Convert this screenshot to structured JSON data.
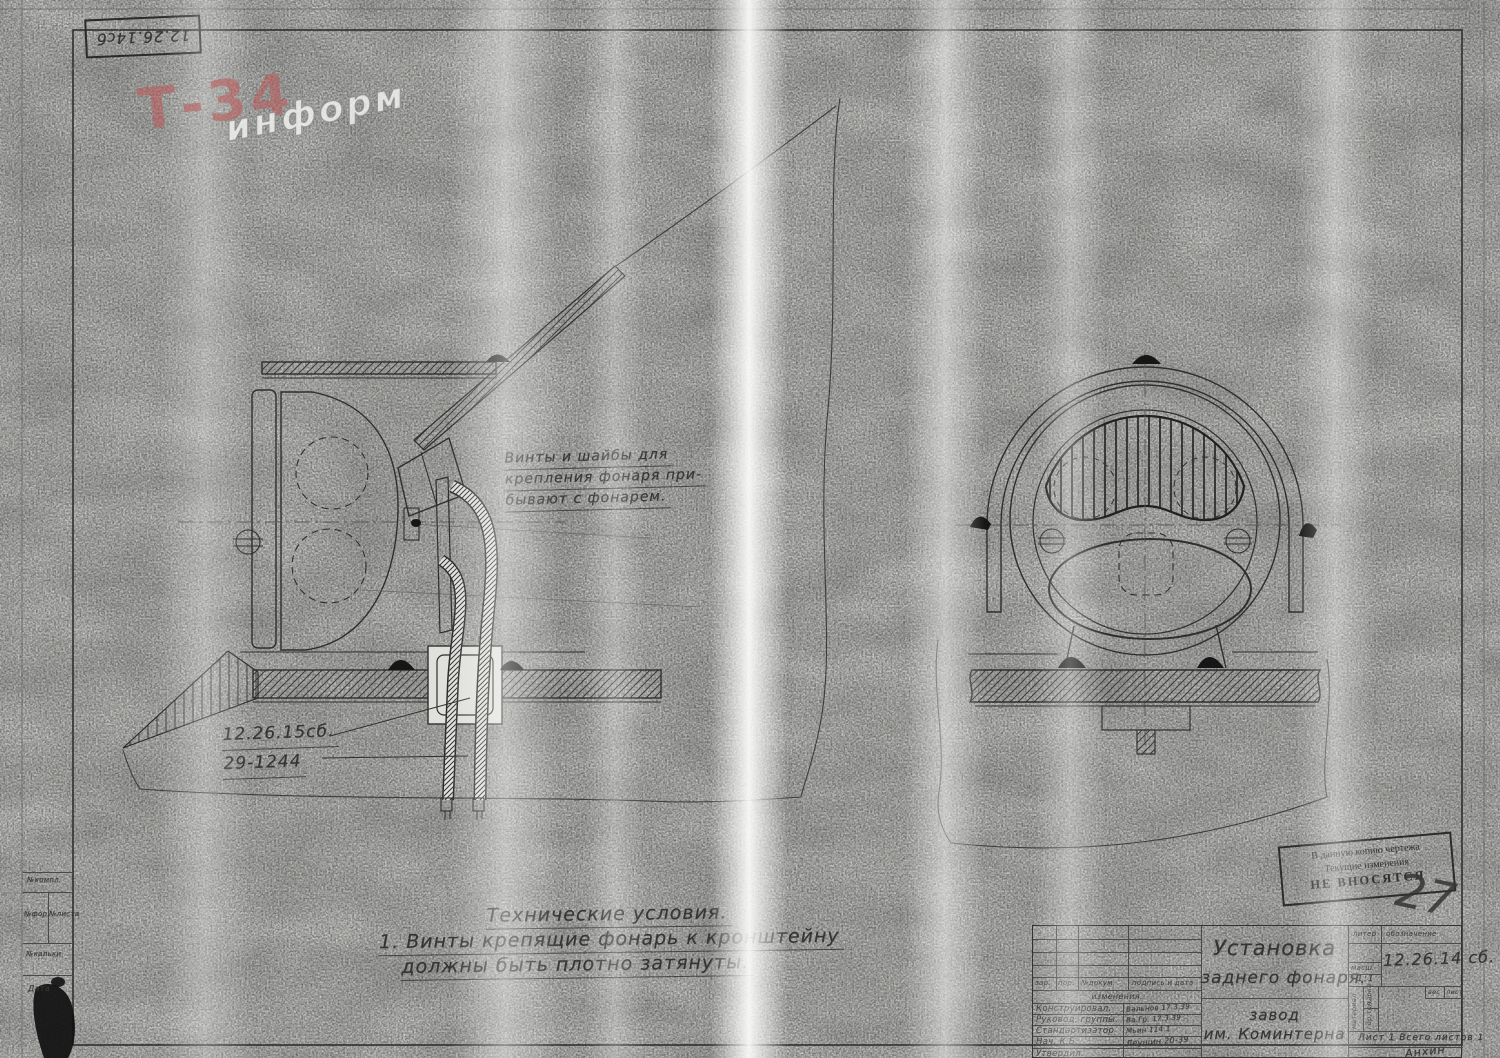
{
  "colors": {
    "paper": "#d8d8d5",
    "ink": "#2e2e2e",
    "watermark_red": "#bc5858"
  },
  "sheet": {
    "corner_code": "12.26.14сб"
  },
  "watermark": {
    "main": "Т-34",
    "sub": "информ"
  },
  "annotations": {
    "note": [
      "Винты и шайбы для",
      "крепления фонаря при-",
      "бывают с фонарем."
    ],
    "part_label_1": "12.26.15сб.",
    "part_label_2": "29-1244",
    "tech_title": "Технические условия.",
    "tech_line_1": "1. Винты крепящие фонарь к кронштейну",
    "tech_line_2": "должны быть плотно затянуты."
  },
  "stamp": {
    "line1": "В данную копию чертежа",
    "line2": "Текущие изменения",
    "line3": "НЕ ВНОСЯТСЯ",
    "mark": "27"
  },
  "margin_table": {
    "row1": "№компл.",
    "row2a": "№фор.",
    "row2b": "№листа",
    "row3": "№кальки",
    "row4": "Дата"
  },
  "title_block": {
    "rev_cols": [
      "зар.",
      "пор.",
      "№докум.",
      "подпись и дата"
    ],
    "rev_caption": "изменения.",
    "roles": [
      {
        "label": "Конструировал.",
        "sign": "Вальнов 17.3.39"
      },
      {
        "label": "Руковод. группы.",
        "sign": "Ва.Гр. 17.3.39"
      },
      {
        "label": "Стандартизатор",
        "sign": "Мьин 114.1"
      },
      {
        "label": "Нач. К.Б.",
        "sign": "Леушин 20-39"
      },
      {
        "label": "Утвердил.",
        "sign": ""
      }
    ],
    "title_line1": "Установка",
    "title_line2": "заднего фонаря.",
    "factory_line1": "завод",
    "factory_line2": "им. Коминтерна",
    "liter": "литер",
    "oboznachenie": "обозначение",
    "scale_label": "масш.",
    "scale_value": "1:1",
    "designation": "12.26.14 сб.",
    "weight_label": "вес",
    "list_label": "лист",
    "material": "материал",
    "marka": "марка",
    "gortop": "гор.топ.",
    "sheets": "Лист 1   Всего листов 1",
    "sign_bottom": "Анхин"
  }
}
